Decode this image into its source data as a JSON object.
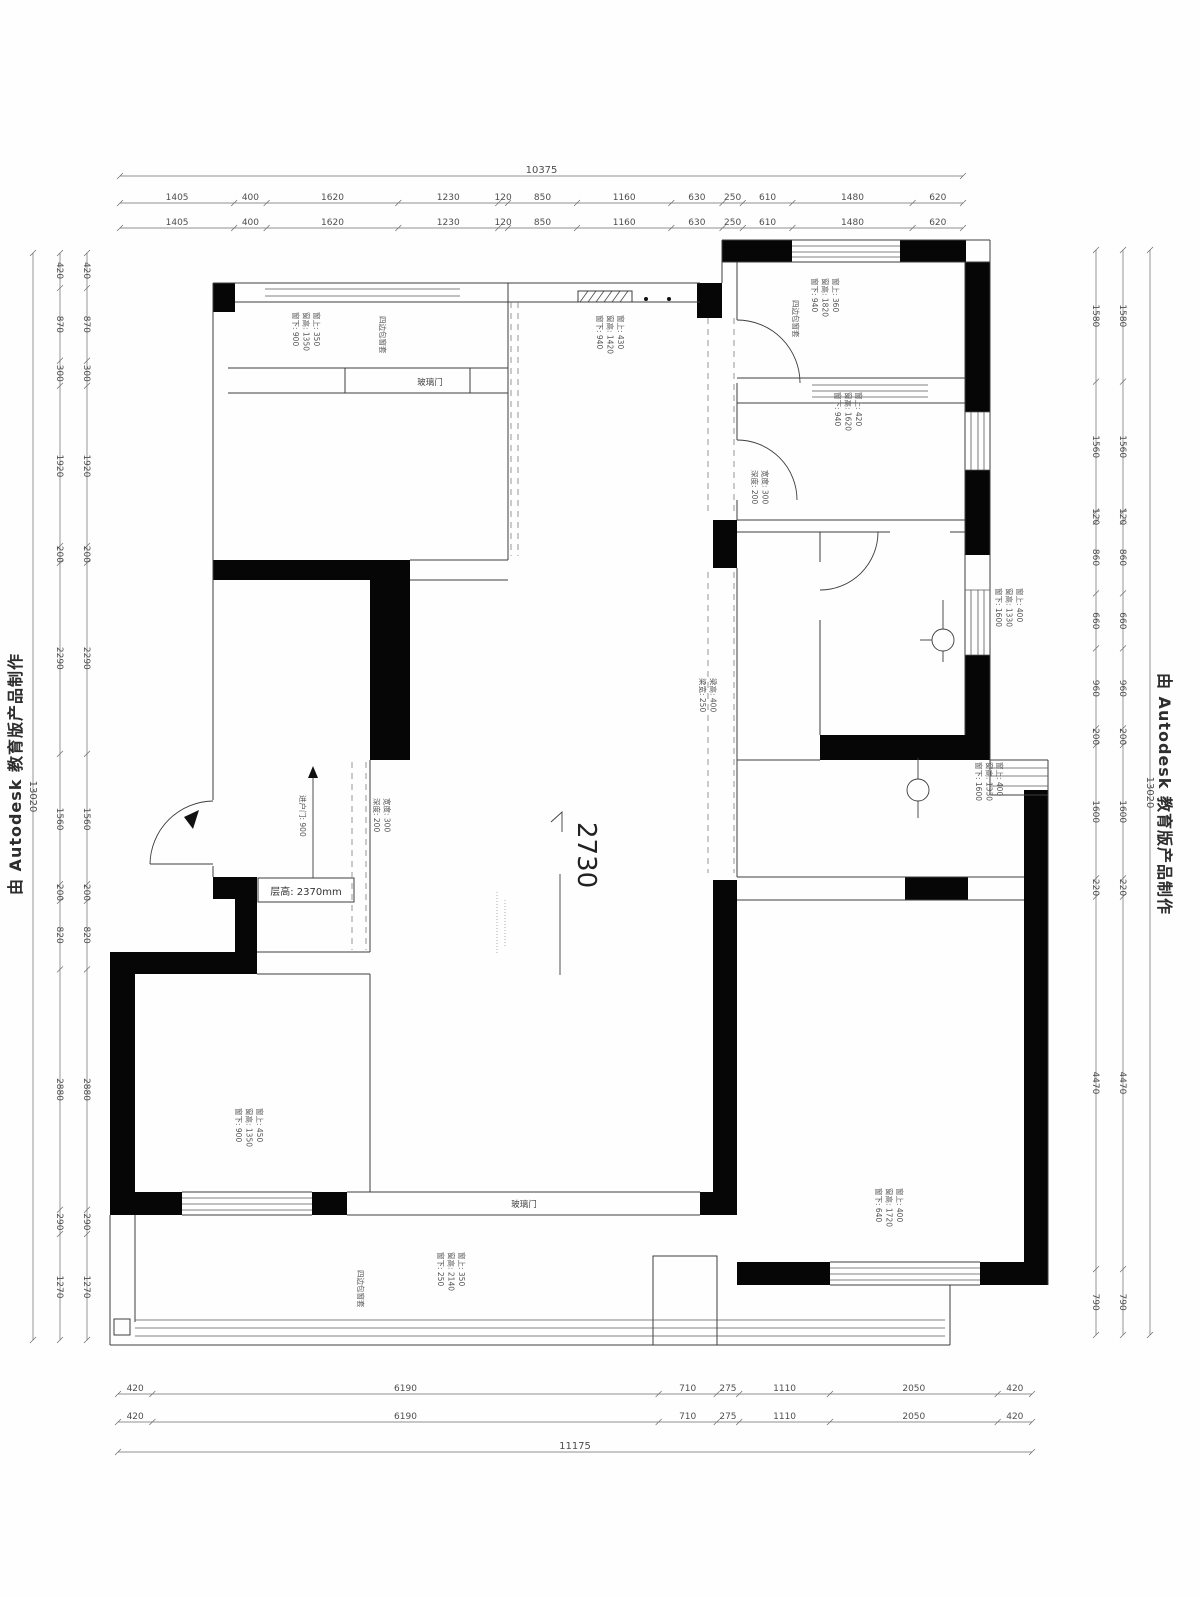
{
  "watermarks": {
    "left": "由 Autodesk 教育版产品制作",
    "right": "由 Autodesk 教育版产品制作"
  },
  "dims": {
    "top_total": [
      "10375"
    ],
    "top": [
      "1405",
      "400",
      "1620",
      "1230",
      "120",
      "850",
      "1160",
      "630",
      "250",
      "610",
      "1480",
      "620"
    ],
    "left_total": [
      "13020"
    ],
    "left": [
      "420",
      "870",
      "300",
      "1920",
      "200",
      "2290",
      "1560",
      "200",
      "820",
      "2880",
      "290",
      "1270"
    ],
    "right": [
      "1580",
      "1560",
      "120",
      "860",
      "660",
      "960",
      "200",
      "1600",
      "220",
      "4470",
      "790"
    ],
    "right_total": [
      "13020"
    ],
    "bottom": [
      "420",
      "6190",
      "710",
      "275",
      "1110",
      "2050",
      "420"
    ],
    "bottom_total": [
      "11175"
    ]
  },
  "labels": {
    "elevation": "2730",
    "ceiling_height": "层高: 2370mm",
    "glass_door_top": "玻璃门",
    "glass_door_bottom": "玻璃门",
    "entry_door": "进户门: 900",
    "casing_tl": "四边包窗套",
    "casing_tr": "四边包窗套",
    "casing_balcony": "四边包窗套",
    "win_tl": [
      "窗上: 350",
      "窗高: 1350",
      "窗下: 900"
    ],
    "win_kitchen": [
      "窗上: 430",
      "窗高: 1420",
      "窗下: 940"
    ],
    "win_tr_upper": [
      "窗上: 360",
      "窗高: 1820",
      "窗下: 940"
    ],
    "win_tr_lower": [
      "窗上: 420",
      "窗高: 1620",
      "窗下: 940"
    ],
    "win_right_mid": [
      "窗上: 400",
      "窗高: 1330",
      "窗下: 1600"
    ],
    "win_right_mid2": [
      "窗上: 400",
      "窗高: 1330",
      "窗下: 1600"
    ],
    "win_bl": [
      "窗上: 450",
      "窗高: 1350",
      "窗下: 900"
    ],
    "win_balcony": [
      "窗上: 350",
      "窗高: 2140",
      "窗下: 250"
    ],
    "win_br": [
      "窗上: 400",
      "窗高: 1720",
      "窗下: 640"
    ],
    "curtain_box_tr": [
      "宽度: 300",
      "深度: 200"
    ],
    "curtain_box_hall": [
      "宽度: 300",
      "深度: 200"
    ],
    "beam_center": [
      "梁高: 400",
      "梁宽: 250"
    ]
  }
}
